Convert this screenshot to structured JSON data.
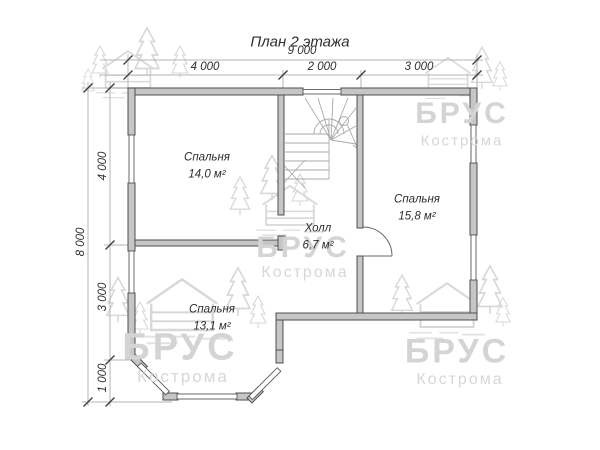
{
  "title": "План 2 этажа",
  "dimensions": {
    "top_total": "9 000",
    "top_segments": [
      "4 000",
      "2 000",
      "3 000"
    ],
    "left_total": "8 000",
    "left_segments": [
      "4 000",
      "3 000",
      "1 000"
    ]
  },
  "rooms": [
    {
      "id": "bedroom-top-left",
      "name": "Спальня",
      "area": "14,0 м²"
    },
    {
      "id": "bedroom-right",
      "name": "Спальня",
      "area": "15,8 м²"
    },
    {
      "id": "bedroom-bottom",
      "name": "Спальня",
      "area": "13,1 м²"
    },
    {
      "id": "hall",
      "name": "Холл",
      "area": "6,7 м²"
    }
  ],
  "watermark": {
    "brand": "БРУС",
    "city": "Кострома"
  },
  "colors": {
    "background": "#ffffff",
    "wall_fill": "#c6c6c6",
    "wall_stroke": "#4f4f4f",
    "window_fill": "#ffffff",
    "dimension_line": "#b5b5b5",
    "tick": "#3c3c3c",
    "text": "#2e2e2e",
    "stair_line": "#aaaaaa",
    "watermark": "#d6d6d6"
  }
}
